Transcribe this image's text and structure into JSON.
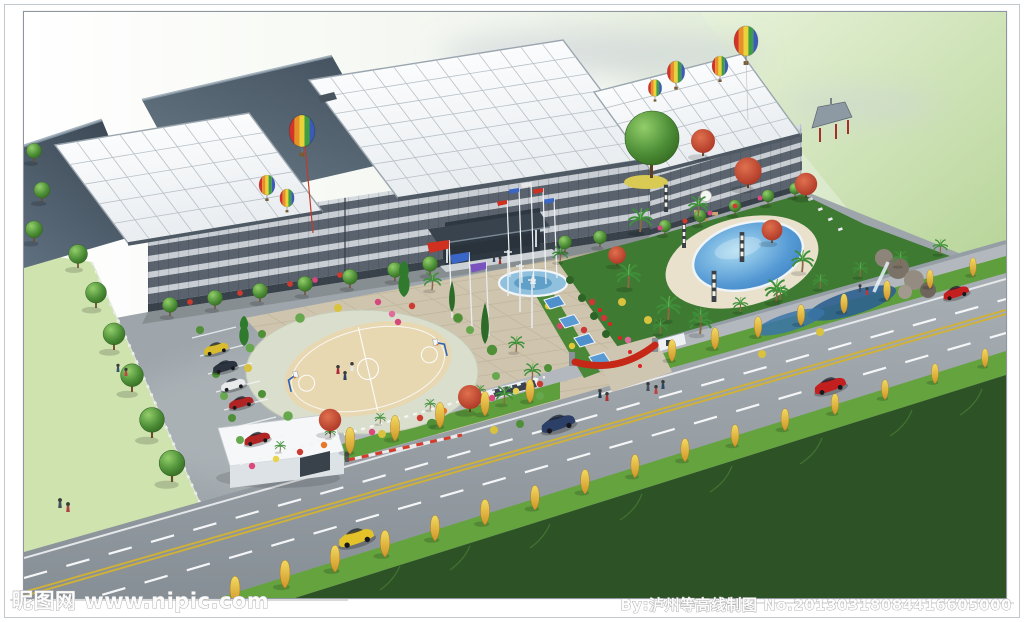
{
  "frame": {
    "border_color": "#98a0a8"
  },
  "watermarks": {
    "site": "昵图网 www.nipic.com",
    "credit": "By:泸州等高线制图 No.20130318084416605000"
  },
  "scene": {
    "description": "Aerial architectural rendering of a factory campus: gray multi-storey buildings with white gridded roofs and slate warehouse roofs, hot-air balloons, landscaped grounds with a circular basketball court, flagpole fountain plaza, blue walkway shelters, palm garden with swimming pool, rockery waterfall and pavilion, gatehouse with barrier, and a tree-lined road with cars.",
    "colors": {
      "sky_green": "#cfe3b6",
      "roof_white": "#f2f4f6",
      "roof_slate": "#4c5a66",
      "facade_dark": "#59626d",
      "facade_light": "#c9ced4",
      "road_asphalt": "#939aa0",
      "verge_green": "#5f9e3c",
      "street_tree_yellow": "#e5c64a",
      "pool_blue": "#4a94d0",
      "court_tan": "#e7d8b2",
      "plaza_beige": "#cfc5ae",
      "grass_dark": "#2d5226",
      "lawn_light": "#cfe3ae",
      "flag_red": "#d03020",
      "flag_blue": "#3a66c8",
      "flag_purple": "#7a52c0",
      "banner_red": "#c62818"
    },
    "elements": [
      "factory-buildings",
      "white-grid-roofs",
      "slate-roofs",
      "entrance-canopy",
      "flags",
      "hot-air-balloons",
      "basketball-court",
      "fountain-flag-plaza",
      "walkway-shelters",
      "swimming-pool",
      "rockery-waterfall",
      "pavilion",
      "palm-garden",
      "gatehouse",
      "barrier-gate",
      "parking-cars",
      "road",
      "street-trees",
      "pedestrians"
    ]
  }
}
